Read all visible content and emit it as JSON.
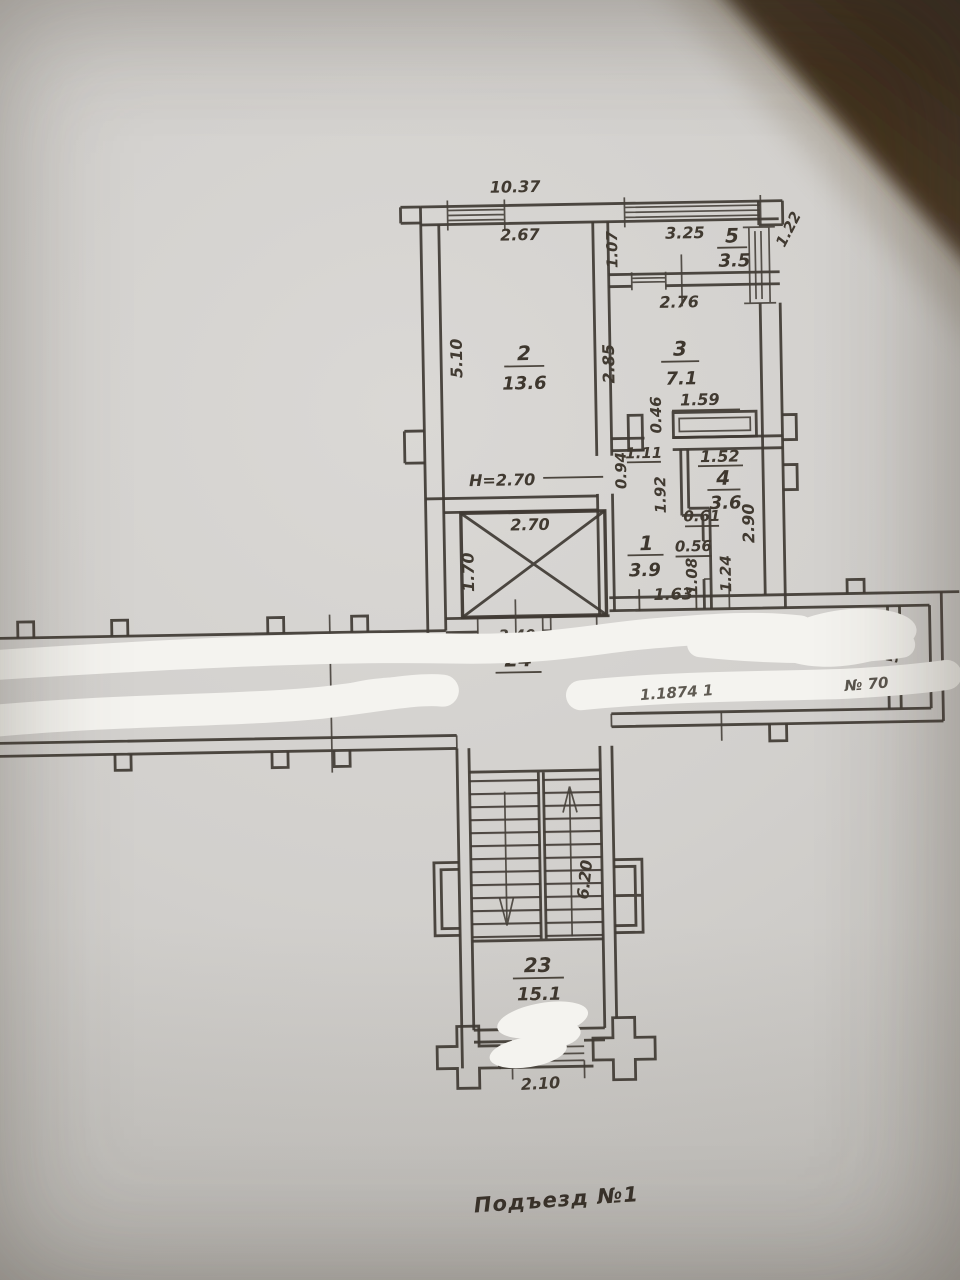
{
  "meta": {
    "kind": "floor-plan photo",
    "sheet_note": "Подъезд №1"
  },
  "colors": {
    "paper": "#d2d0cd",
    "ink": "#3f3933",
    "whiteout": "#f4f3ef",
    "table_corner": "#44311f"
  },
  "footer": {
    "label": "Подъезд №1"
  },
  "rooms": {
    "r1": {
      "number": "1",
      "area": "3.9"
    },
    "r2": {
      "number": "2",
      "area": "13.6"
    },
    "r3": {
      "number": "3",
      "area": "7.1"
    },
    "r4": {
      "number": "4",
      "area": "3.6"
    },
    "r5": {
      "number": "5",
      "area": "3.5"
    },
    "r23": {
      "number": "23",
      "area": "15.1"
    },
    "r24": {
      "number": "24",
      "area": ""
    }
  },
  "dims": {
    "overall_width": "10.37",
    "win_room2": "2.67",
    "win_room5": "3.25",
    "side_win_room5": "1.22",
    "room5_depth": "1.07",
    "room3_width_top": "2.76",
    "room2_height": "5.10",
    "room3_height": "2.85",
    "niche_width": "1.59",
    "niche_depth": "0.46",
    "room4_width": "1.52",
    "hall_top_width": "1.11",
    "hall_left_depth": "0.94",
    "room4_height": "1.92",
    "room4_step": "0.61",
    "room4_right_height": "2.90",
    "hall_mid_width": "0.56",
    "hall_lower_left": "1.08",
    "hall_lower_right": "1.24",
    "hall_door_width": "1.63",
    "ceiling_height": "H=2.70",
    "lift_width": "2.70",
    "lift_depth": "1.70",
    "corridor_right_gap": "56",
    "stair_length": "6.20",
    "stair_window_width": "2.10"
  },
  "fragments": {
    "covered_corridor_dim": "3.40",
    "covered_right_dim": "3.37",
    "covered_serial": "1.1874 1",
    "covered_unit_no": "№ 70"
  }
}
